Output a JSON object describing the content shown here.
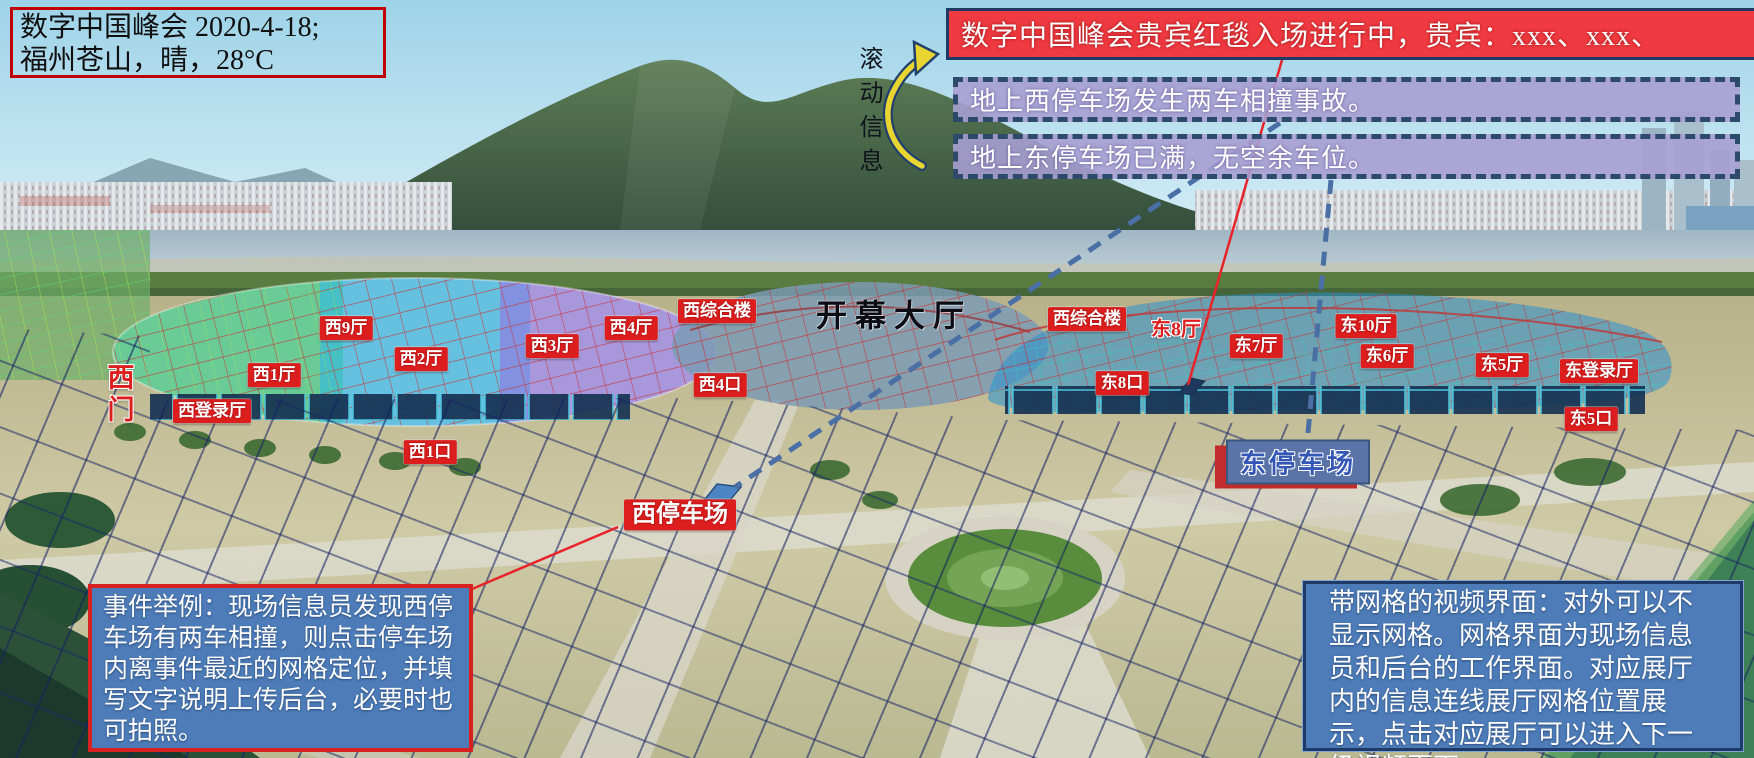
{
  "info_box": {
    "line1": "数字中国峰会 2020-4-18;",
    "line2": "福州苍山，晴，28°C"
  },
  "scroll_label": "滚动信息",
  "banner": {
    "text": "数字中国峰会贵宾红毯入场进行中，贵宾：xxx、xxx、"
  },
  "alerts": [
    {
      "text": "地上西停车场发生两车相撞事故。"
    },
    {
      "text": "地上东停车场已满，无空余车位。"
    }
  ],
  "example_box": {
    "text": "事件举例：现场信息员发现西停车场有两车相撞，则点击停车场内离事件最近的网格定位，并填写文字说明上传后台，必要时也可拍照。"
  },
  "note_box": {
    "text": "带网格的视频界面：对外可以不显示网格。网格界面为现场信息员和后台的工作界面。对应展厅内的信息连线展厅网格位置展示，点击对应展厅可以进入下一级视频页面。"
  },
  "venue_labels": [
    {
      "text": "西9厅",
      "x": 346,
      "y": 328,
      "kind": "box",
      "name": "hall-label-west-9"
    },
    {
      "text": "西2厅",
      "x": 421,
      "y": 359,
      "kind": "box",
      "name": "hall-label-west-2"
    },
    {
      "text": "西3厅",
      "x": 552,
      "y": 346,
      "kind": "box",
      "name": "hall-label-west-3"
    },
    {
      "text": "西4厅",
      "x": 631,
      "y": 328,
      "kind": "box",
      "name": "hall-label-west-4"
    },
    {
      "text": "西综合楼",
      "x": 717,
      "y": 311,
      "kind": "box",
      "name": "west-complex-label-1"
    },
    {
      "text": "西1厅",
      "x": 274,
      "y": 375,
      "kind": "box",
      "name": "hall-label-west-1"
    },
    {
      "text": "西登录厅",
      "x": 212,
      "y": 411,
      "kind": "box",
      "name": "west-registration-hall-label"
    },
    {
      "text": "西4口",
      "x": 720,
      "y": 385,
      "kind": "box",
      "name": "gate-label-west-4"
    },
    {
      "text": "西1口",
      "x": 430,
      "y": 452,
      "kind": "box",
      "name": "gate-label-west-1"
    },
    {
      "text": "西停车场",
      "x": 680,
      "y": 515,
      "kind": "box box-lg",
      "name": "west-parking-label"
    },
    {
      "text": "西综合楼",
      "x": 1087,
      "y": 319,
      "kind": "box",
      "name": "west-complex-label-2"
    },
    {
      "text": "东8厅",
      "x": 1176,
      "y": 327,
      "kind": "outline",
      "name": "hall-label-east-8"
    },
    {
      "text": "东7厅",
      "x": 1256,
      "y": 346,
      "kind": "box",
      "name": "hall-label-east-7"
    },
    {
      "text": "东10厅",
      "x": 1366,
      "y": 326,
      "kind": "box",
      "name": "hall-label-east-10"
    },
    {
      "text": "东6厅",
      "x": 1387,
      "y": 356,
      "kind": "box",
      "name": "hall-label-east-6"
    },
    {
      "text": "东5厅",
      "x": 1502,
      "y": 365,
      "kind": "box",
      "name": "hall-label-east-5"
    },
    {
      "text": "东登录厅",
      "x": 1599,
      "y": 371,
      "kind": "box",
      "name": "east-registration-hall-label"
    },
    {
      "text": "东5口",
      "x": 1591,
      "y": 419,
      "kind": "box",
      "name": "gate-label-east-5"
    },
    {
      "text": "东8口",
      "x": 1122,
      "y": 383,
      "kind": "box",
      "name": "gate-label-east-8"
    },
    {
      "text": "西门",
      "x": 119,
      "y": 395,
      "kind": "outline vertical",
      "name": "west-gate-label"
    },
    {
      "text": "开幕大厅",
      "x": 894,
      "y": 313,
      "kind": "title",
      "name": "opening-hall-label"
    },
    {
      "text": "东停车场",
      "x": 1298,
      "y": 462,
      "kind": "east-parking",
      "name": "east-parking-label"
    }
  ],
  "connectors": {
    "red_lines": [
      [
        1282,
        60,
        1188,
        385
      ],
      [
        618,
        527,
        472,
        589
      ]
    ],
    "blue_dashed_lines": [
      [
        1280,
        123,
        735,
        487
      ],
      [
        1331,
        180,
        1307,
        444
      ]
    ]
  },
  "colors": {
    "banner_red": "#ee3a40",
    "label_red": "#dd1e1e",
    "alert_fill": "rgba(167,159,208,0.9)",
    "dash_border": "#2e4a6b",
    "panel_blue": "#4d7cb8",
    "panel_border_red": "#d92121",
    "panel_border_navy": "#1f3a66",
    "info_border_red": "#c00000",
    "line_red": "#e8232a",
    "line_blue": "#4a6fa5",
    "arrow_yellow": "#e8d532"
  }
}
